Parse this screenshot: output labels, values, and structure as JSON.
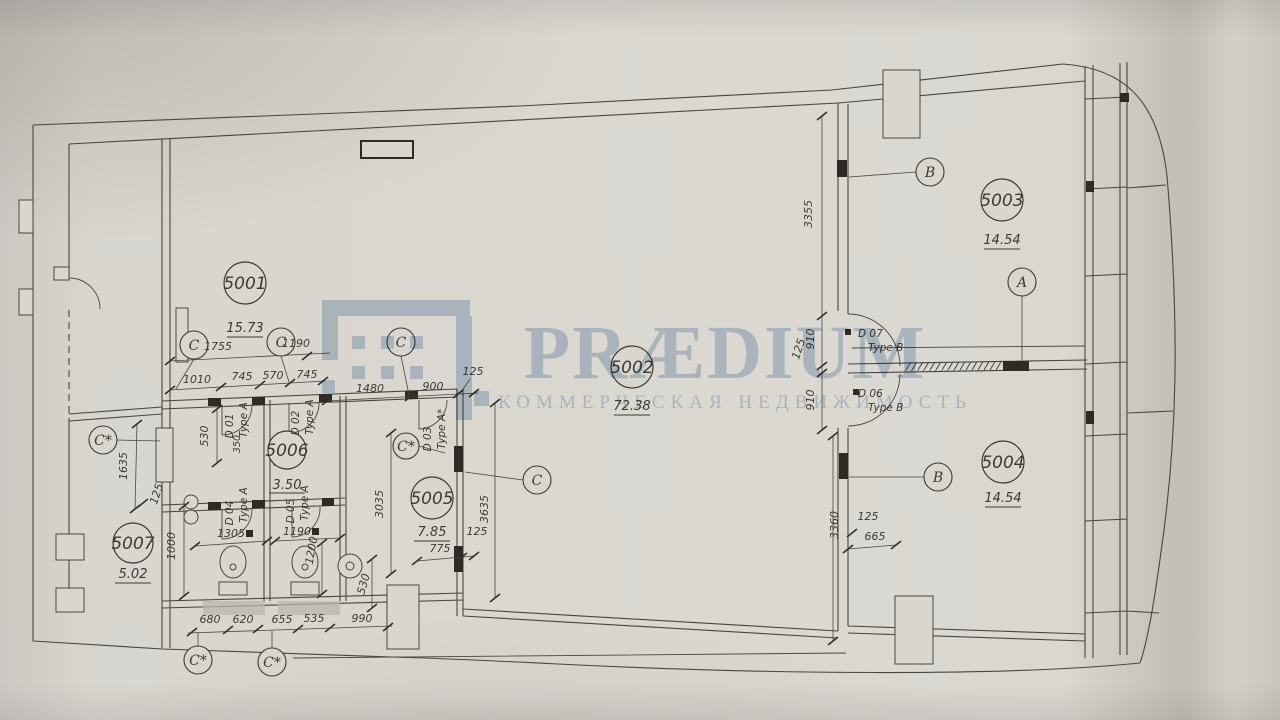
{
  "watermark": {
    "brand": "PRÆDIUM",
    "tagline": "КОММЕРЧЕСКАЯ НЕДВИЖИМОСТЬ",
    "color": "#b7c9dd"
  },
  "rooms": [
    {
      "number": "5001",
      "area": "15.73"
    },
    {
      "number": "5002",
      "area": "72.38"
    },
    {
      "number": "5003",
      "area": "14.54"
    },
    {
      "number": "5004",
      "area": "14.54"
    },
    {
      "number": "5005",
      "area": "7.85"
    },
    {
      "number": "5006",
      "area": "3.50"
    },
    {
      "number": "5007",
      "area": "5.02"
    }
  ],
  "axes": [
    {
      "label": "C"
    },
    {
      "label": "C"
    },
    {
      "label": "C"
    },
    {
      "label": "C*"
    },
    {
      "label": "C*"
    },
    {
      "label": "C"
    },
    {
      "label": "B"
    },
    {
      "label": "A"
    },
    {
      "label": "B"
    },
    {
      "label": "C*"
    },
    {
      "label": "C*"
    }
  ],
  "doors": [
    {
      "id": "D 01",
      "type": "Type A"
    },
    {
      "id": "D 02",
      "type": "Type A"
    },
    {
      "id": "D 03",
      "type": "Type A*"
    },
    {
      "id": "D 04",
      "type": "Type A"
    },
    {
      "id": "D 05",
      "type": "Type A"
    },
    {
      "id": "D 07",
      "type": "Type B"
    },
    {
      "id": "D 06",
      "type": "Type B"
    }
  ],
  "dims": [
    "1755",
    "1190",
    "1010",
    "745",
    "570",
    "745",
    "1480",
    "900",
    "125",
    "530",
    "350",
    "1635",
    "125",
    "1000",
    "1305",
    "1190",
    "1200",
    "530",
    "3035",
    "3635",
    "775",
    "125",
    "680",
    "620",
    "655",
    "535",
    "990",
    "3355",
    "910",
    "125",
    "910",
    "3360",
    "125",
    "665"
  ]
}
